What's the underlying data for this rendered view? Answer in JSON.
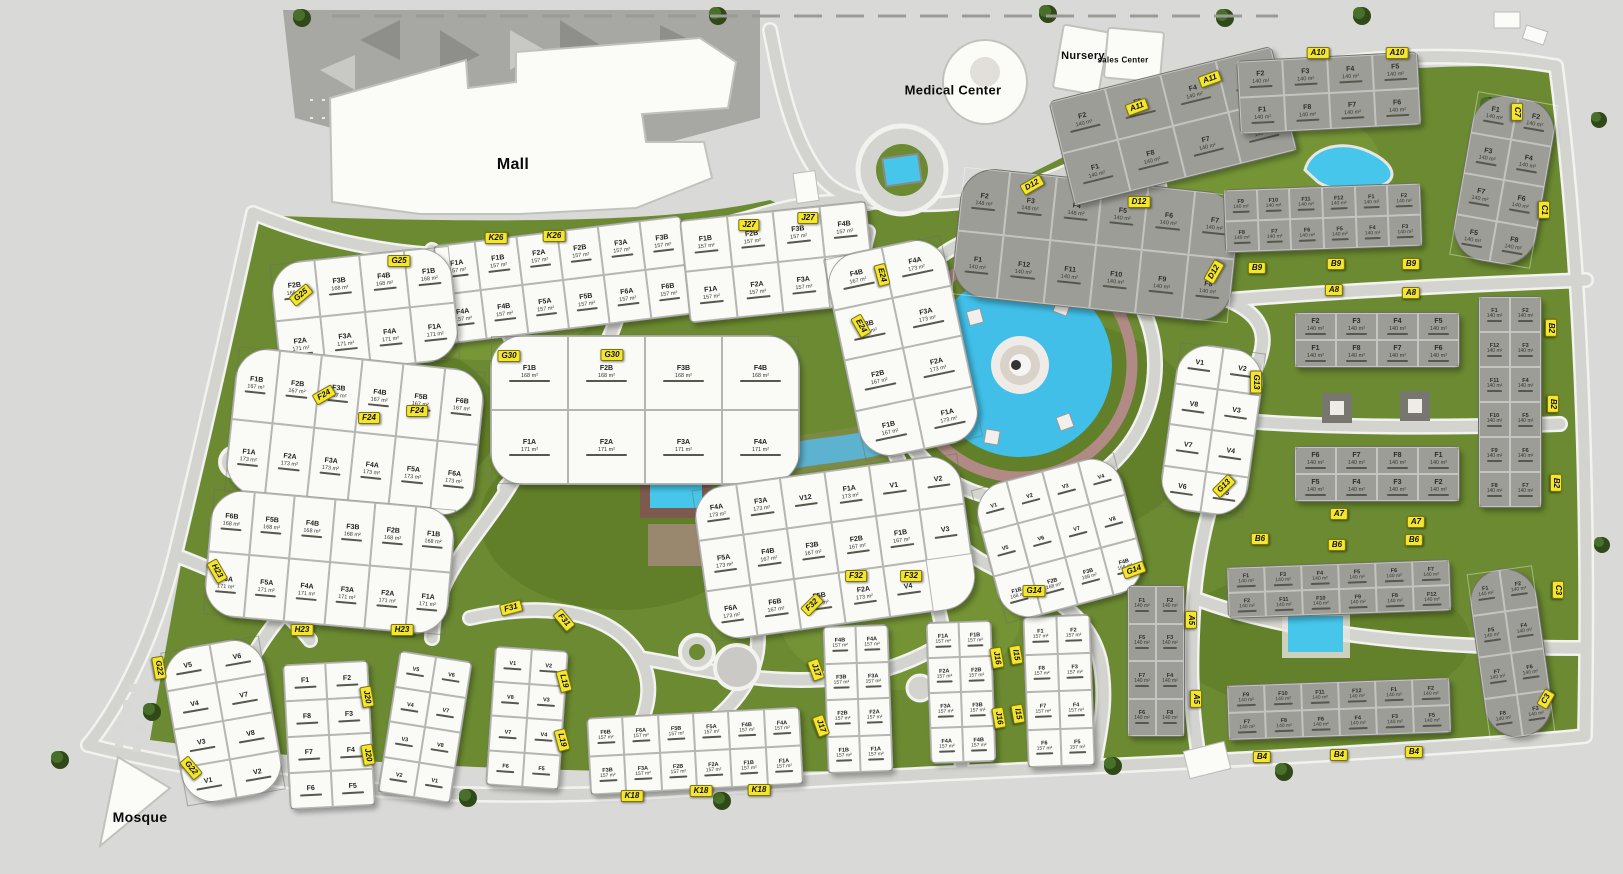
{
  "landmarks": {
    "mall": {
      "label": "Mall"
    },
    "medical": {
      "label": "Medical Center"
    },
    "nursery": {
      "label": "Nursery"
    },
    "sales": {
      "label": "sales Center"
    },
    "mosque": {
      "label": "Mosque"
    }
  },
  "colors": {
    "ground": "#d9d9d7",
    "green": "#6b8a31",
    "green_dark": "#55701f",
    "green_light": "#83a33e",
    "road": "#d3d3d0",
    "road_edge": "#f2f2ef",
    "water": "#41bfe8",
    "promenade": "#b18a85",
    "building_white": "#fafaf7",
    "building_gray": "#9d9d97",
    "marker_yellow": "#f4e62e",
    "parking": "#a7a7a3"
  },
  "markers": [
    {
      "code": "A10",
      "x": 1318,
      "y": 53,
      "rot": 0
    },
    {
      "code": "A10",
      "x": 1397,
      "y": 53,
      "rot": 0
    },
    {
      "code": "A11",
      "x": 1137,
      "y": 107,
      "rot": -20
    },
    {
      "code": "A11",
      "x": 1210,
      "y": 79,
      "rot": -20
    },
    {
      "code": "C7",
      "x": 1517,
      "y": 112,
      "rot": 90
    },
    {
      "code": "C1",
      "x": 1544,
      "y": 210,
      "rot": 90
    },
    {
      "code": "B9",
      "x": 1257,
      "y": 268,
      "rot": 0
    },
    {
      "code": "B9",
      "x": 1336,
      "y": 264,
      "rot": 0
    },
    {
      "code": "B9",
      "x": 1411,
      "y": 264,
      "rot": 0
    },
    {
      "code": "A8",
      "x": 1334,
      "y": 290,
      "rot": 0
    },
    {
      "code": "A8",
      "x": 1411,
      "y": 293,
      "rot": 0
    },
    {
      "code": "B2",
      "x": 1551,
      "y": 328,
      "rot": 90
    },
    {
      "code": "B2",
      "x": 1553,
      "y": 404,
      "rot": 90
    },
    {
      "code": "B2",
      "x": 1556,
      "y": 483,
      "rot": 90
    },
    {
      "code": "A7",
      "x": 1339,
      "y": 514,
      "rot": 0
    },
    {
      "code": "A7",
      "x": 1416,
      "y": 522,
      "rot": 0
    },
    {
      "code": "B6",
      "x": 1260,
      "y": 539,
      "rot": 0
    },
    {
      "code": "B6",
      "x": 1337,
      "y": 545,
      "rot": 0
    },
    {
      "code": "B6",
      "x": 1414,
      "y": 540,
      "rot": 0
    },
    {
      "code": "A5",
      "x": 1191,
      "y": 620,
      "rot": 90
    },
    {
      "code": "A5",
      "x": 1196,
      "y": 699,
      "rot": 90
    },
    {
      "code": "B4",
      "x": 1262,
      "y": 757,
      "rot": 0
    },
    {
      "code": "B4",
      "x": 1339,
      "y": 755,
      "rot": 0
    },
    {
      "code": "B4",
      "x": 1414,
      "y": 752,
      "rot": 0
    },
    {
      "code": "C3",
      "x": 1558,
      "y": 590,
      "rot": 90
    },
    {
      "code": "C3",
      "x": 1546,
      "y": 699,
      "rot": -60
    },
    {
      "code": "D12",
      "x": 1032,
      "y": 185,
      "rot": -30
    },
    {
      "code": "D12",
      "x": 1139,
      "y": 202,
      "rot": 0
    },
    {
      "code": "D12",
      "x": 1214,
      "y": 272,
      "rot": -60
    },
    {
      "code": "G13",
      "x": 1256,
      "y": 382,
      "rot": 90
    },
    {
      "code": "G13",
      "x": 1224,
      "y": 486,
      "rot": -45
    },
    {
      "code": "G14",
      "x": 1034,
      "y": 591,
      "rot": 0
    },
    {
      "code": "G14",
      "x": 1134,
      "y": 570,
      "rot": -20
    },
    {
      "code": "I15",
      "x": 1016,
      "y": 655,
      "rot": 80
    },
    {
      "code": "I15",
      "x": 1018,
      "y": 714,
      "rot": 80
    },
    {
      "code": "J16",
      "x": 997,
      "y": 658,
      "rot": 80
    },
    {
      "code": "J16",
      "x": 999,
      "y": 718,
      "rot": 80
    },
    {
      "code": "J17",
      "x": 816,
      "y": 670,
      "rot": 70
    },
    {
      "code": "J17",
      "x": 821,
      "y": 726,
      "rot": 70
    },
    {
      "code": "K18",
      "x": 632,
      "y": 796,
      "rot": 0
    },
    {
      "code": "K18",
      "x": 701,
      "y": 791,
      "rot": 0
    },
    {
      "code": "K18",
      "x": 759,
      "y": 790,
      "rot": 0
    },
    {
      "code": "L19",
      "x": 564,
      "y": 681,
      "rot": 75
    },
    {
      "code": "L19",
      "x": 562,
      "y": 740,
      "rot": 75
    },
    {
      "code": "F31",
      "x": 511,
      "y": 608,
      "rot": -15
    },
    {
      "code": "F31",
      "x": 564,
      "y": 620,
      "rot": 50
    },
    {
      "code": "F32",
      "x": 856,
      "y": 576,
      "rot": 0
    },
    {
      "code": "F32",
      "x": 911,
      "y": 576,
      "rot": 0
    },
    {
      "code": "F32",
      "x": 812,
      "y": 605,
      "rot": -45
    },
    {
      "code": "H23",
      "x": 217,
      "y": 571,
      "rot": 60
    },
    {
      "code": "H23",
      "x": 302,
      "y": 630,
      "rot": 0
    },
    {
      "code": "H23",
      "x": 402,
      "y": 630,
      "rot": 0
    },
    {
      "code": "G22",
      "x": 159,
      "y": 668,
      "rot": 80
    },
    {
      "code": "G22",
      "x": 191,
      "y": 768,
      "rot": 50
    },
    {
      "code": "J20",
      "x": 367,
      "y": 697,
      "rot": 80
    },
    {
      "code": "J20",
      "x": 368,
      "y": 755,
      "rot": 80
    },
    {
      "code": "E24",
      "x": 882,
      "y": 275,
      "rot": 75
    },
    {
      "code": "E24",
      "x": 861,
      "y": 326,
      "rot": 60
    },
    {
      "code": "F24",
      "x": 324,
      "y": 395,
      "rot": -30
    },
    {
      "code": "F24",
      "x": 369,
      "y": 418,
      "rot": 0
    },
    {
      "code": "F24",
      "x": 417,
      "y": 411,
      "rot": 0
    },
    {
      "code": "G30",
      "x": 509,
      "y": 356,
      "rot": 0
    },
    {
      "code": "G30",
      "x": 612,
      "y": 355,
      "rot": 0
    },
    {
      "code": "G25",
      "x": 399,
      "y": 261,
      "rot": 0
    },
    {
      "code": "G25",
      "x": 301,
      "y": 295,
      "rot": -40
    },
    {
      "code": "K26",
      "x": 496,
      "y": 238,
      "rot": 0
    },
    {
      "code": "K26",
      "x": 554,
      "y": 236,
      "rot": 0
    },
    {
      "code": "J27",
      "x": 749,
      "y": 225,
      "rot": 0
    },
    {
      "code": "J27",
      "x": 808,
      "y": 218,
      "rot": 0
    }
  ],
  "clusters": [
    {
      "code": "K26",
      "shape": "bar",
      "color": "white",
      "x": 438,
      "y": 230,
      "w": 250,
      "h": 100,
      "rot": -7,
      "cols": 6,
      "units": [
        "F1A 157",
        "F1B 157",
        "F2A 157",
        "F2B 157",
        "F3A 157",
        "F3B 157",
        "F4A 157",
        "F4B 157",
        "F5A 157",
        "F5B 157",
        "F6A 157",
        "F6B 157"
      ]
    },
    {
      "code": "J27",
      "shape": "bar",
      "color": "white",
      "x": 684,
      "y": 210,
      "w": 188,
      "h": 104,
      "rot": -6,
      "cols": 4,
      "units": [
        "F1B 157",
        "F2B 157",
        "F3B 157",
        "F4B 157",
        "F1A 157",
        "F2A 157",
        "F3A 157",
        "F4A 157"
      ]
    },
    {
      "code": "G25",
      "shape": "arc",
      "color": "white",
      "x": 274,
      "y": 254,
      "w": 182,
      "h": 115,
      "rot": -6,
      "cols": 4,
      "units": [
        "F2B 168",
        "F3B 168",
        "F4B 168",
        "F1B 168",
        "F2A 171",
        "F3A 171",
        "F4A 171",
        "F1A 171"
      ]
    },
    {
      "code": "G30",
      "shape": "arc",
      "color": "white",
      "x": 490,
      "y": 335,
      "w": 310,
      "h": 150,
      "rot": 0,
      "cols": 4,
      "units": [
        "F1B 168",
        "F2B 168",
        "F3B 168",
        "F4B 168",
        "F1A 171",
        "F2A 171",
        "F3A 171",
        "F4A 171"
      ]
    },
    {
      "code": "F24",
      "shape": "arc",
      "color": "white",
      "x": 230,
      "y": 358,
      "w": 250,
      "h": 148,
      "rot": 6,
      "cols": 6,
      "units": [
        "F1B 167",
        "F2B 167",
        "F3B 167",
        "F4B 167",
        "F5B 167",
        "F6B 167",
        "F1A 173",
        "F2A 173",
        "F3A 173",
        "F4A 173",
        "F5A 173",
        "F6A 173"
      ]
    },
    {
      "code": "E24",
      "shape": "arc",
      "color": "white",
      "x": 842,
      "y": 244,
      "w": 122,
      "h": 208,
      "rot": -12,
      "cols": 2,
      "units": [
        "F4B 167",
        "F4A 173",
        "F3B 167",
        "F3A 173",
        "F2B 167",
        "F2A 173",
        "F1B 167",
        "F1A 173"
      ]
    },
    {
      "code": "H23",
      "shape": "arc",
      "color": "white",
      "x": 207,
      "y": 498,
      "w": 245,
      "h": 128,
      "rot": 5,
      "cols": 6,
      "units": [
        "F6B 168",
        "F5B 168",
        "F4B 168",
        "F3B 168",
        "F2B 168",
        "F1B 168",
        "F6A 171",
        "F5A 171",
        "F4A 171",
        "F3A 171",
        "F2A 171",
        "F1A 171"
      ]
    },
    {
      "code": "F32",
      "shape": "arc",
      "color": "white",
      "x": 700,
      "y": 470,
      "w": 270,
      "h": 155,
      "rot": -8,
      "cols": 6,
      "units": [
        "F4A 173",
        "F3A 173",
        "V12",
        "F1A 173",
        "V1",
        "V2",
        "F5A 173",
        "F4B 167",
        "F3B 167",
        "F2B 167",
        "F1B 167",
        "V3",
        "F6A 173",
        "F6B 167",
        "F5B 167",
        "F2A 173",
        "V4"
      ]
    },
    {
      "code": "K18",
      "shape": "bar",
      "color": "white",
      "x": 588,
      "y": 712,
      "w": 214,
      "h": 78,
      "rot": -3,
      "cols": 6,
      "units": [
        "F6B 157",
        "F6A 157",
        "F5B 157",
        "F5A 157",
        "F4B 157",
        "F4A 157",
        "F3B 157",
        "F3A 157",
        "F2B 157",
        "F2A 157",
        "F1B 157",
        "F1A 157"
      ]
    },
    {
      "code": "L19",
      "shape": "bar",
      "color": "white",
      "x": 388,
      "y": 655,
      "w": 74,
      "h": 144,
      "rot": 9,
      "cols": 2,
      "units": [
        "V5",
        "V6",
        "V4",
        "V7",
        "V3",
        "V8",
        "V2",
        "V1"
      ]
    },
    {
      "code": "L19",
      "shape": "bar",
      "color": "white",
      "x": 490,
      "y": 648,
      "w": 74,
      "h": 140,
      "rot": 4,
      "cols": 2,
      "units": [
        "V1",
        "V2",
        "V8",
        "V3",
        "V7",
        "V4",
        "F6",
        "F5"
      ]
    },
    {
      "code": "G22",
      "shape": "arc",
      "color": "white",
      "x": 172,
      "y": 642,
      "w": 102,
      "h": 158,
      "rot": -10,
      "cols": 2,
      "units": [
        "V5",
        "V6",
        "V4",
        "V7",
        "V3",
        "V8",
        "V1",
        "V2"
      ]
    },
    {
      "code": "J20",
      "shape": "bar",
      "color": "white",
      "x": 286,
      "y": 662,
      "w": 86,
      "h": 146,
      "rot": -3,
      "cols": 2,
      "units": [
        "F1",
        "F2",
        "F8",
        "F3",
        "F7",
        "F4",
        "F6",
        "F5"
      ]
    },
    {
      "code": "J17",
      "shape": "bar",
      "color": "white",
      "x": 825,
      "y": 625,
      "w": 66,
      "h": 148,
      "rot": -2,
      "cols": 2,
      "units": [
        "F4B 157",
        "F4A 157",
        "F3B 157",
        "F3A 157",
        "F2B 157",
        "F2A 157",
        "F1B 157",
        "F1A 157"
      ]
    },
    {
      "code": "J16",
      "shape": "bar",
      "color": "white",
      "x": 928,
      "y": 621,
      "w": 66,
      "h": 142,
      "rot": -2,
      "cols": 2,
      "units": [
        "F1A 157",
        "F1B 157",
        "F2A 157",
        "F2B 157",
        "F3A 157",
        "F3B 157",
        "F4A 157",
        "F4B 157"
      ]
    },
    {
      "code": "I15",
      "shape": "bar",
      "color": "white",
      "x": 1025,
      "y": 615,
      "w": 68,
      "h": 152,
      "rot": -2,
      "cols": 2,
      "units": [
        "F1 157",
        "F2 157",
        "F8 157",
        "F3 157",
        "F7 157",
        "F4 157",
        "F6 157",
        "F5 157"
      ]
    },
    {
      "code": "G14",
      "shape": "arc",
      "color": "white",
      "x": 985,
      "y": 468,
      "w": 150,
      "h": 140,
      "rot": -15,
      "cols": 4,
      "units": [
        "V1",
        "V2",
        "V3",
        "V4",
        "V5",
        "V6",
        "V7",
        "V8",
        "F1B 168",
        "F2B 168",
        "F3B 168",
        "F4B 168"
      ]
    },
    {
      "code": "G13",
      "shape": "arc",
      "color": "white",
      "x": 1168,
      "y": 346,
      "w": 88,
      "h": 168,
      "rot": 8,
      "cols": 2,
      "units": [
        "V1",
        "V2",
        "V8",
        "V3",
        "V7",
        "V4",
        "V6",
        "V5"
      ]
    },
    {
      "code": "D12",
      "shape": "arc",
      "color": "gray",
      "x": 956,
      "y": 180,
      "w": 280,
      "h": 130,
      "rot": 6,
      "cols": 6,
      "units": [
        "F2 148",
        "F3 148",
        "F4 148",
        "F5 140",
        "F6 140",
        "F7 140",
        "F1 140",
        "F12 140",
        "F11 140",
        "F10 140",
        "F9 140",
        "F8 140"
      ]
    },
    {
      "code": "A11",
      "shape": "bar",
      "color": "gray",
      "x": 1058,
      "y": 72,
      "w": 230,
      "h": 108,
      "rot": -14,
      "cols": 4,
      "units": [
        "F2 140",
        "F3 140",
        "F4 140",
        "F5 140",
        "F1 140",
        "F8 140",
        "F7 140",
        "F6 140"
      ]
    },
    {
      "code": "A10",
      "shape": "bar",
      "color": "gray",
      "x": 1238,
      "y": 56,
      "w": 182,
      "h": 74,
      "rot": -3,
      "cols": 4,
      "units": [
        "F2 140",
        "F3 140",
        "F4 140",
        "F5 140",
        "F1 140",
        "F8 140",
        "F7 140",
        "F6 140"
      ]
    },
    {
      "code": "B9",
      "shape": "bar",
      "color": "gray",
      "x": 1224,
      "y": 186,
      "w": 198,
      "h": 64,
      "rot": -2,
      "cols": 6,
      "units": [
        "F9 140",
        "F10 140",
        "F11 140",
        "F12 140",
        "F1 140",
        "F2 140",
        "F8 140",
        "F7 140",
        "F6 140",
        "F5 140",
        "F4 140",
        "F3 140"
      ]
    },
    {
      "code": "C7",
      "shape": "arc",
      "color": "gray",
      "x": 1462,
      "y": 96,
      "w": 84,
      "h": 168,
      "rot": 10,
      "cols": 2,
      "units": [
        "F1 140",
        "F2 140",
        "F3 140",
        "F4 140",
        "F7 140",
        "F6 140",
        "F5 140",
        "F8 140"
      ]
    },
    {
      "code": "B2",
      "shape": "bar",
      "color": "gray",
      "x": 1478,
      "y": 296,
      "w": 64,
      "h": 212,
      "rot": 0,
      "cols": 2,
      "units": [
        "F1 140",
        "F2 140",
        "F12 140",
        "F3 140",
        "F11 140",
        "F4 140",
        "F10 140",
        "F5 140",
        "F9 140",
        "F6 140",
        "F8 140",
        "F7 140"
      ]
    },
    {
      "code": "A8",
      "shape": "bar",
      "color": "gray",
      "x": 1294,
      "y": 312,
      "w": 166,
      "h": 56,
      "rot": 0,
      "cols": 4,
      "units": [
        "F2 140",
        "F3 140",
        "F4 140",
        "F5 140",
        "F1 140",
        "F8 140",
        "F7 140",
        "F6 140"
      ]
    },
    {
      "code": "A8",
      "shape": "bar",
      "color": "gray",
      "x": 1294,
      "y": 446,
      "w": 166,
      "h": 56,
      "rot": 0,
      "cols": 4,
      "units": [
        "F6 140",
        "F7 140",
        "F8 140",
        "F1 140",
        "F5 140",
        "F4 140",
        "F3 140",
        "F2 140"
      ]
    },
    {
      "code": "B6",
      "shape": "bar",
      "color": "gray",
      "x": 1227,
      "y": 563,
      "w": 224,
      "h": 52,
      "rot": -2,
      "cols": 6,
      "units": [
        "F1 140",
        "F3 140",
        "F4 140",
        "F5 140",
        "F6 140",
        "F7 140",
        "F2 140",
        "F11 140",
        "F10 140",
        "F9 140",
        "F8 140",
        "F12 140"
      ]
    },
    {
      "code": "B4",
      "shape": "bar",
      "color": "gray",
      "x": 1227,
      "y": 681,
      "w": 224,
      "h": 56,
      "rot": -2,
      "cols": 6,
      "units": [
        "F9 140",
        "F10 140",
        "F11 140",
        "F12 140",
        "F1 140",
        "F2 140",
        "F7 140",
        "F8 140",
        "F6 140",
        "F4 140",
        "F3 140",
        "F5 140"
      ]
    },
    {
      "code": "A5",
      "shape": "bar",
      "color": "gray",
      "x": 1127,
      "y": 585,
      "w": 58,
      "h": 152,
      "rot": 0,
      "cols": 2,
      "units": [
        "F1 140",
        "F2 140",
        "F5 140",
        "F3 140",
        "F7 140",
        "F4 140",
        "F6 140",
        "F8 140"
      ]
    },
    {
      "code": "C3",
      "shape": "arc",
      "color": "gray",
      "x": 1477,
      "y": 568,
      "w": 68,
      "h": 170,
      "rot": -8,
      "cols": 2,
      "units": [
        "F1 140",
        "F2 140",
        "F5 140",
        "F4 140",
        "F7 140",
        "F6 140",
        "F8 140",
        "F3 140"
      ]
    }
  ]
}
